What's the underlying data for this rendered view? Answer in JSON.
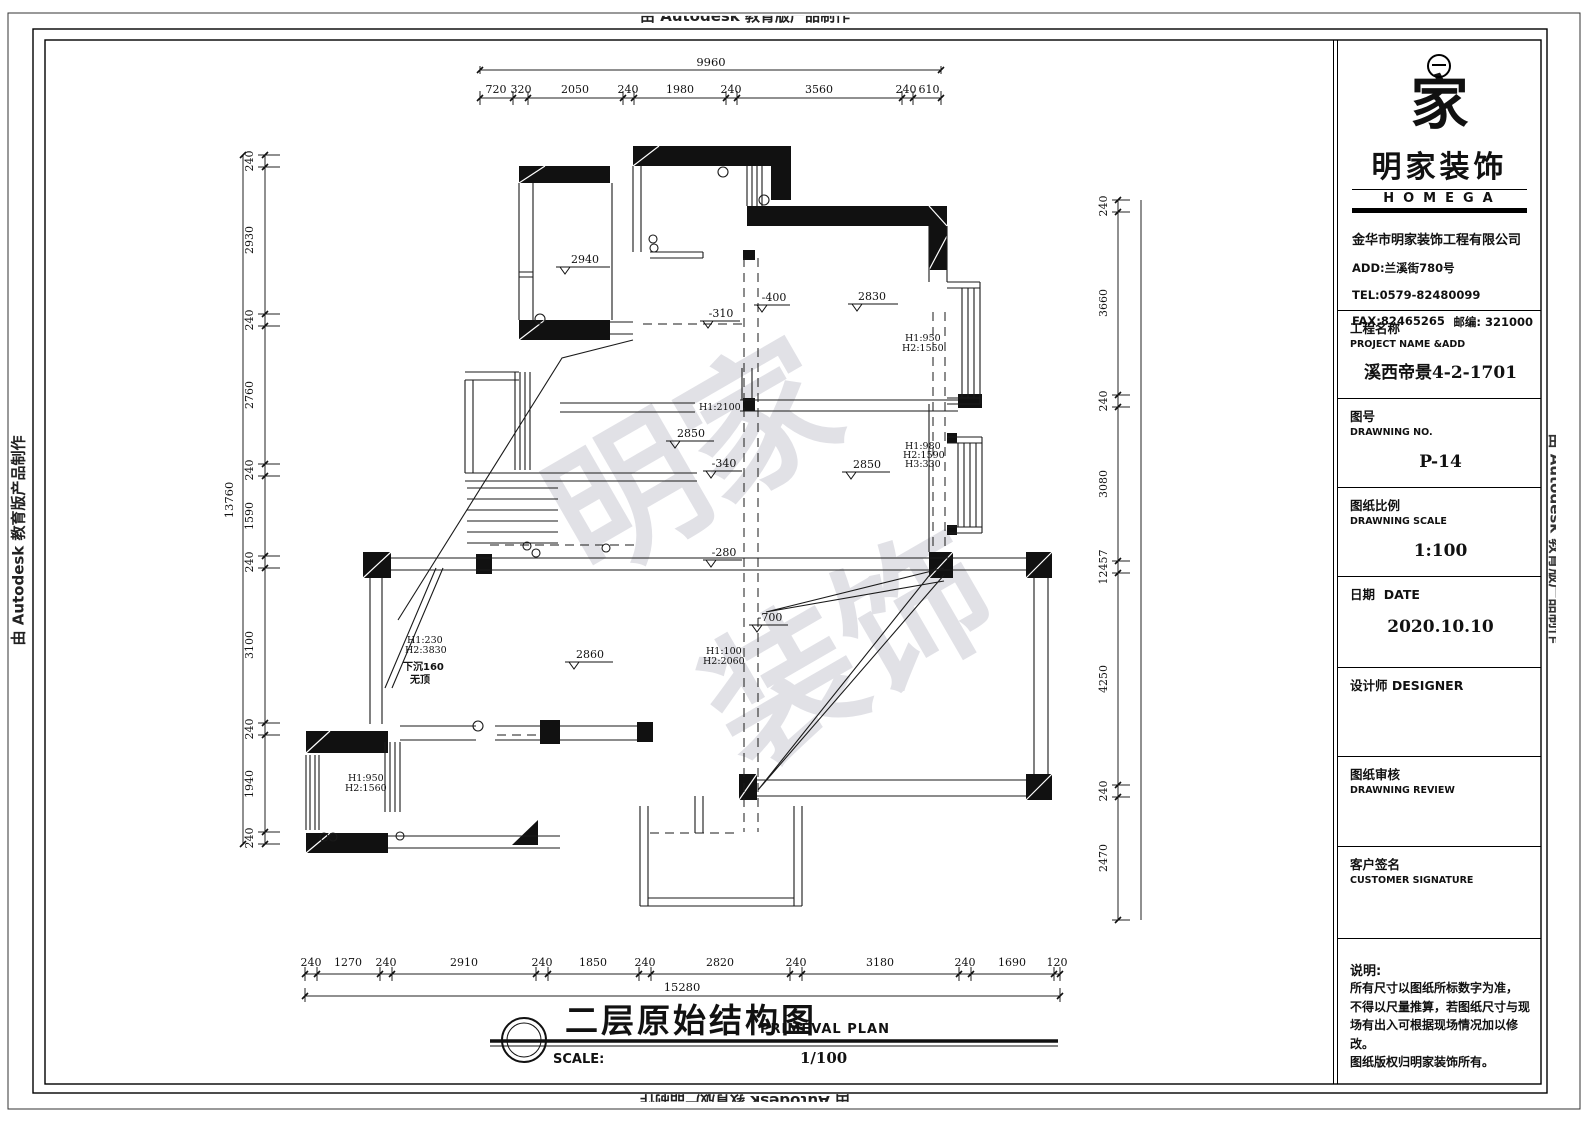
{
  "edge_marks": {
    "top": "由 Autodesk 教育版产品制作",
    "bottom": "由 Autodesk 教育版产品制作",
    "left": "由 Autodesk 教育版产品制作",
    "right": "由 Autodesk 教育版产品制作"
  },
  "title_block": {
    "logo_glyph": "家",
    "brand": "明家装饰",
    "brand_en": "HOMEGA",
    "company": "金华市明家装饰工程有限公司",
    "address": "ADD:兰溪街780号",
    "tel": "TEL:0579-82480099",
    "fax": "FAX:82465265",
    "postal": "邮编: 321000",
    "project_label": "工程名称",
    "project_label_en": "PROJECT NAME &ADD",
    "project_value": "溪西帝景4-2-1701",
    "no_label": "图号",
    "no_label_en": "DRAWNING NO.",
    "no_value": "P-14",
    "scale_label": "图纸比例",
    "scale_label_en": "DRAWNING SCALE",
    "scale_value": "1:100",
    "date_label": "日期",
    "date_label_en": "DATE",
    "date_value": "2020.10.10",
    "designer_label": "设计师",
    "designer_label_en": "DESIGNER",
    "review_label": "图纸审核",
    "review_label_en": "DRAWNING REVIEW",
    "signature_label": "客户签名",
    "signature_label_en": "CUSTOMER SIGNATURE",
    "notes_label": "说明:",
    "notes_line1": "所有尺寸以图纸所标数字为准，",
    "notes_line2": "不得以尺量推算，若图纸尺寸与现",
    "notes_line3": "场有出入可根据现场情况加以修改。",
    "notes_line4": "图纸版权归明家装饰所有。"
  },
  "drawing_title": {
    "cn": "二层原始结构图",
    "en": "PRIMEVAL PLAN",
    "scale_label": "SCALE:",
    "scale_value": "1/100"
  },
  "dims": {
    "top_total": "9960",
    "top": [
      "720",
      "320",
      "2050",
      "240",
      "1980",
      "240",
      "3560",
      "240",
      "610"
    ],
    "bottom_total": "15280",
    "bottom": [
      "240",
      "1270",
      "240",
      "2910",
      "240",
      "1850",
      "240",
      "2820",
      "240",
      "3180",
      "240",
      "1690",
      "120"
    ],
    "left_total": "13760",
    "left": [
      "240",
      "2930",
      "240",
      "2760",
      "240",
      "1590",
      "240",
      "3100",
      "240",
      "1940",
      "240"
    ],
    "right": [
      "240",
      "3660",
      "240",
      "3080",
      "12457",
      "4250",
      "240",
      "2470"
    ]
  },
  "plan": {
    "elev_2940": "2940",
    "elev_m310": "-310",
    "elev_m400": "-400",
    "elev_2830": "2830",
    "elev_2850a": "2850",
    "elev_2850b": "2850",
    "elev_m340": "-340",
    "elev_m280": "-280",
    "elev_m700": "-700",
    "elev_2860": "2860",
    "h950a_1": "H1:950",
    "h950a_2": "H2:1550",
    "h2100": "H1:2100",
    "h980_1": "H1:980",
    "h980_2": "H2:1590",
    "h980_3": "H3:330",
    "h230_1": "H1:230",
    "h230_2": "H2:3830",
    "sunken_1": "下沉160",
    "sunken_2": "无顶",
    "h100_1": "H1:100",
    "h100_2": "H2:2060",
    "h950b_1": "H1:950",
    "h950b_2": "H2:1560"
  },
  "watermark": {
    "part1": "明家",
    "part2": "装饰"
  }
}
